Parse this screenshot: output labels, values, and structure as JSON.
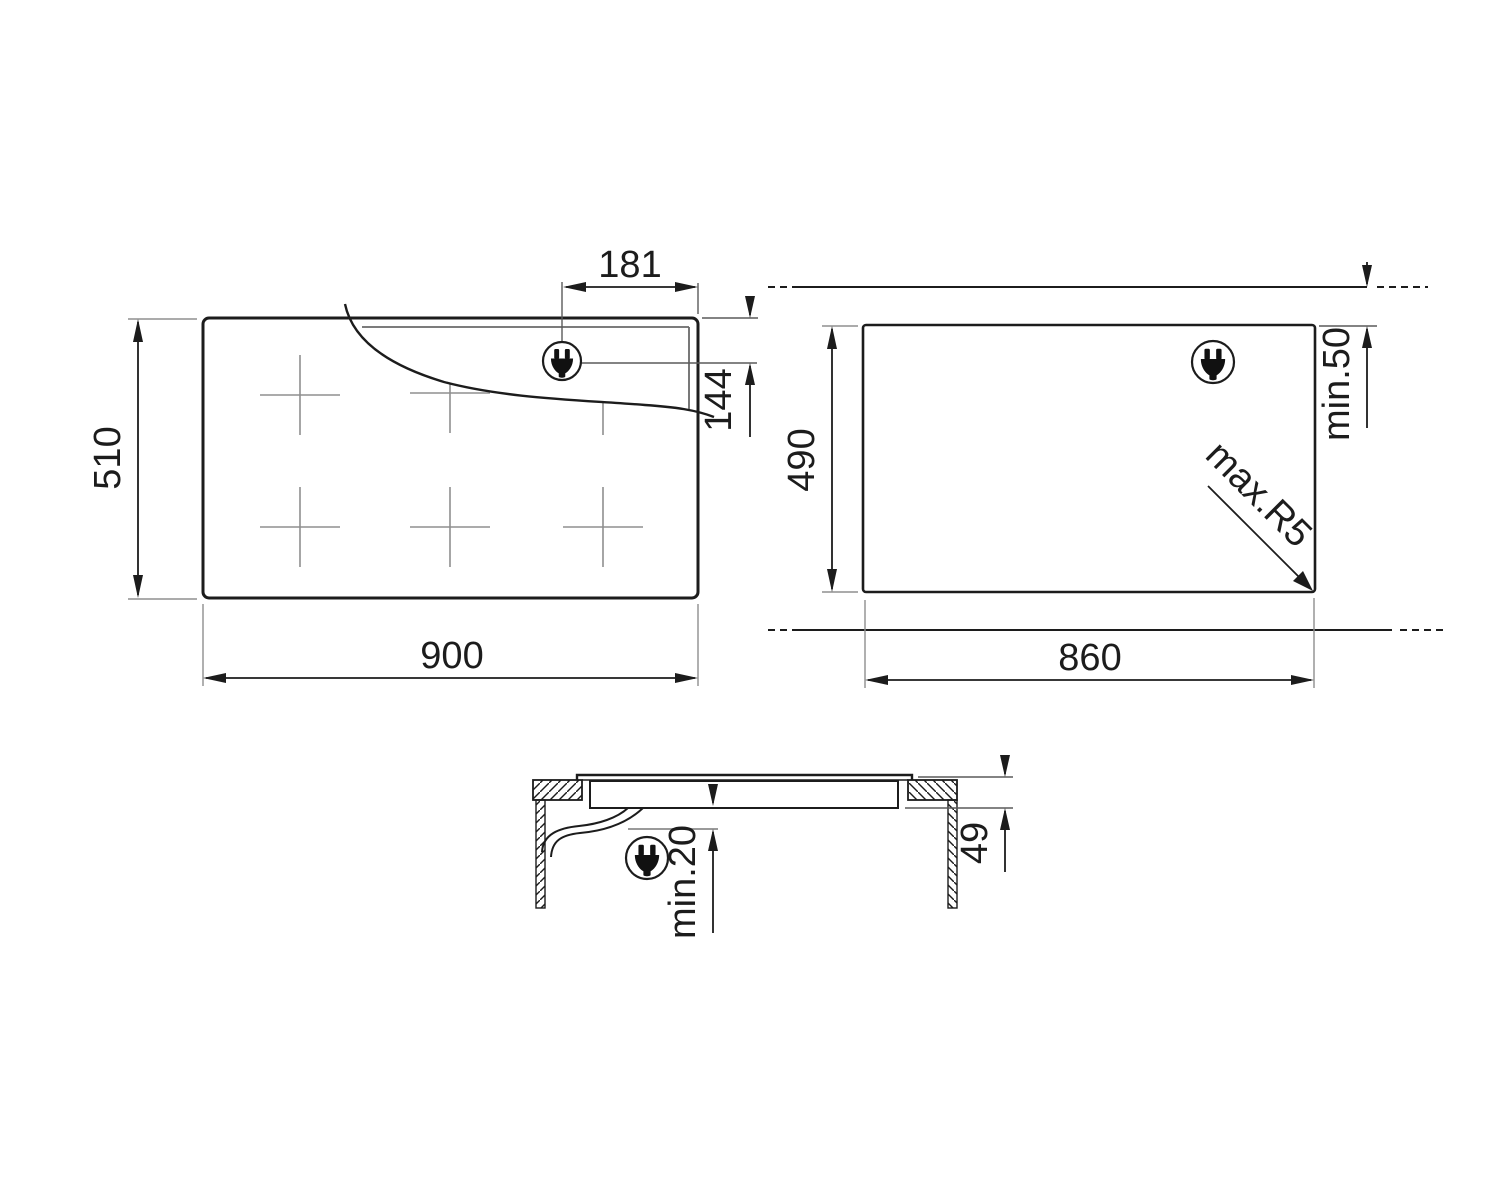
{
  "drawing": {
    "title": "hob-installation-dimensions",
    "views": {
      "top": {
        "width_label": "900",
        "height_label": "510",
        "plug_offset_x_label": "181",
        "plug_offset_y_label": "144"
      },
      "cutout": {
        "width_label": "860",
        "height_label": "490",
        "rear_clearance_label": "min.50",
        "corner_radius_label": "max.R5"
      },
      "section": {
        "body_height_label": "49",
        "below_clearance_label": "min.20"
      }
    },
    "icons": {
      "plug": "power-plug-icon"
    },
    "colors": {
      "line": "#1c1c1c",
      "secondary": "#8f8f8f",
      "background": "#ffffff"
    }
  }
}
